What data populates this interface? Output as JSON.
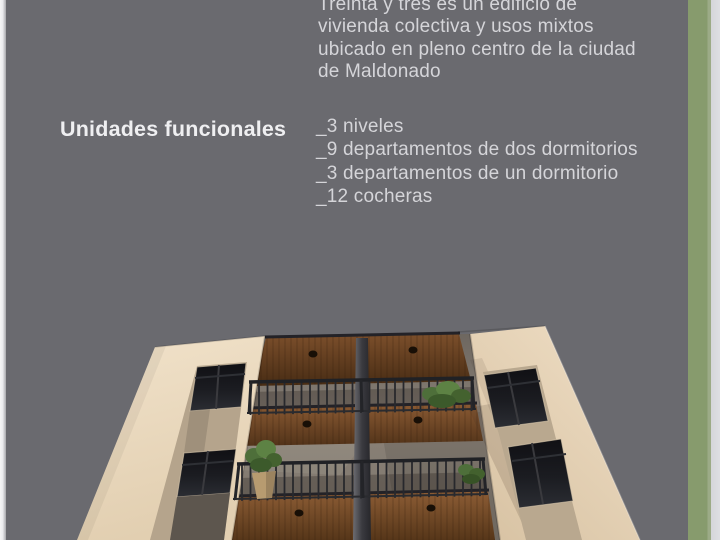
{
  "slide": {
    "intro_lines": [
      "Treinta y tres es un edificio de",
      "vivienda colectiva y usos mixtos",
      "ubicado en pleno centro de la ciudad",
      "de Maldonado"
    ],
    "heading": "Unidades funcionales",
    "unit_list": [
      "_3 niveles",
      "_9 departamentos de dos dormitorios",
      "_3 departamentos de un dormitorio",
      "_12 cocheras"
    ],
    "colors": {
      "background": "#6a6a6f",
      "accent_green": "#879b6d",
      "edge_light": "#d8d9dd",
      "text": "#d5d5d9",
      "heading_text": "#efeff1",
      "wall_beige": "#ecdabf",
      "wood_brown": "#6f4626",
      "railing_dark": "#2a2b2f",
      "recess_gray": "#837b72",
      "window_glass": "#17181c",
      "plant_green": "#527438"
    }
  }
}
